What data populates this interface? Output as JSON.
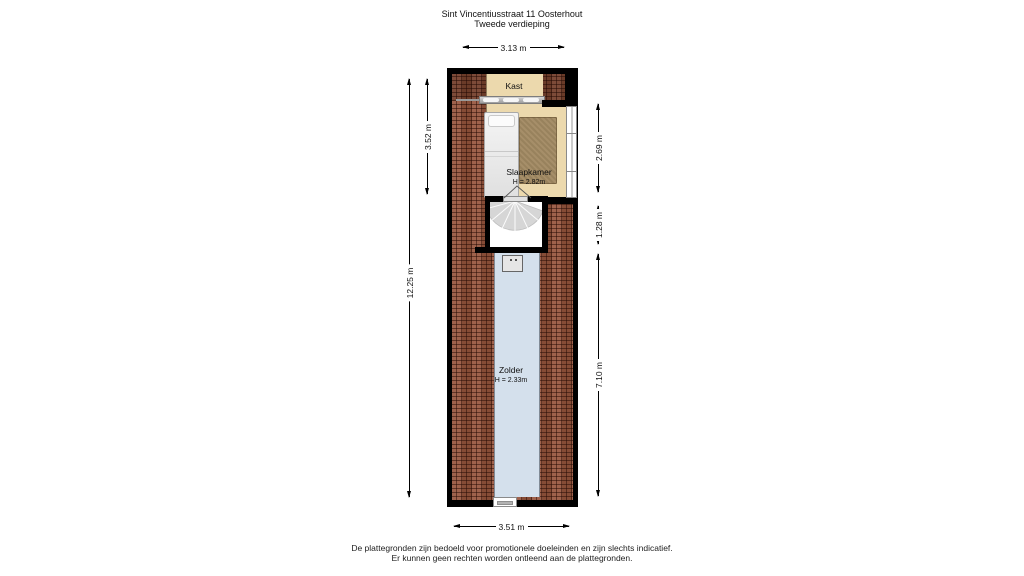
{
  "title": {
    "line1": "Sint Vincentiusstraat 11 Oosterhout",
    "line2": "Tweede verdieping"
  },
  "rooms": {
    "kast": {
      "label": "Kast"
    },
    "slaapkamer": {
      "label": "Slaapkamer",
      "height_label": "H = 2.82m"
    },
    "zolder": {
      "label": "Zolder",
      "height_label": "H = 2.33m"
    }
  },
  "dimensions": {
    "top": "3.13 m",
    "bottom": "3.51 m",
    "left_inner": "3.52 m",
    "left_outer": "12.25 m",
    "right_top": "2.69 m",
    "right_middle": "1.28 m",
    "right_bottom": "7.10 m"
  },
  "fixtures": {
    "wardrobe": "kast-schuifdeuren",
    "bed": "bed",
    "rug": "vloerkleed",
    "staircase": "spiltrap",
    "boiler": "cv-unit",
    "window_right": "raam",
    "window_bottom": "raam"
  },
  "colors": {
    "wall": "#000000",
    "room_floor": "#ecd9ad",
    "roof_tiles": "#98563e",
    "rug": "#a28a63",
    "attic_floor": "#d4e0ec",
    "stairs": "#d6d6d6"
  },
  "footer": {
    "line1": "De plattegronden zijn bedoeld voor promotionele doeleinden en zijn slechts indicatief.",
    "line2": "Er kunnen geen rechten worden ontleend aan de plattegronden."
  }
}
